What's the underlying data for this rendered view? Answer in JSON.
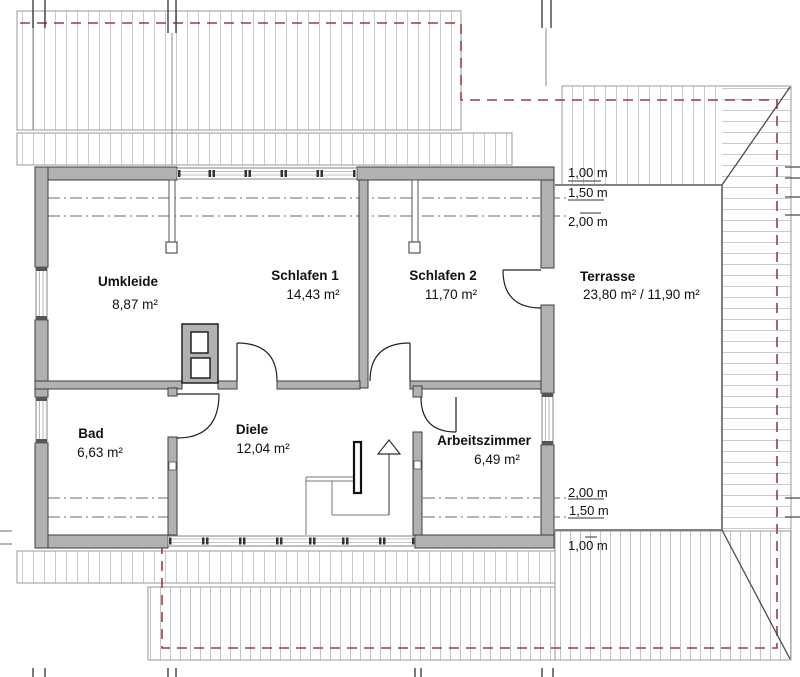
{
  "drawing": {
    "type": "floor-plan",
    "floor": "Dachgeschoss"
  },
  "rooms": [
    {
      "id": "umkleide",
      "name": "Umkleide",
      "area": "8,87 m²"
    },
    {
      "id": "schlafen1",
      "name": "Schlafen 1",
      "area": "14,43 m²"
    },
    {
      "id": "schlafen2",
      "name": "Schlafen 2",
      "area": "11,70 m²"
    },
    {
      "id": "bad",
      "name": "Bad",
      "area": "6,63 m²"
    },
    {
      "id": "diele",
      "name": "Diele",
      "area": "12,04 m²"
    },
    {
      "id": "arbeitszimmer",
      "name": "Arbeitszimmer",
      "area": "6,49 m²"
    },
    {
      "id": "terrasse",
      "name": "Terrasse",
      "area": "23,80 m² / 11,90 m²"
    }
  ],
  "dimensions": {
    "top": [
      {
        "label": "1,00 m"
      },
      {
        "label": "1,50 m"
      },
      {
        "label": "2,00 m"
      }
    ],
    "bottom": [
      {
        "label": "2,00 m"
      },
      {
        "label": "1,50 m"
      },
      {
        "label": "1,00 m"
      }
    ]
  },
  "colors": {
    "wall_fill": "#b1b1b1",
    "wall_outline": "#3d3d3d",
    "rafter_line": "#cbcbcb",
    "roof_outline": "#9a9a9a",
    "red_dashed": "#9e3b3b",
    "terrace_line": "#808080",
    "text": "#111111"
  }
}
